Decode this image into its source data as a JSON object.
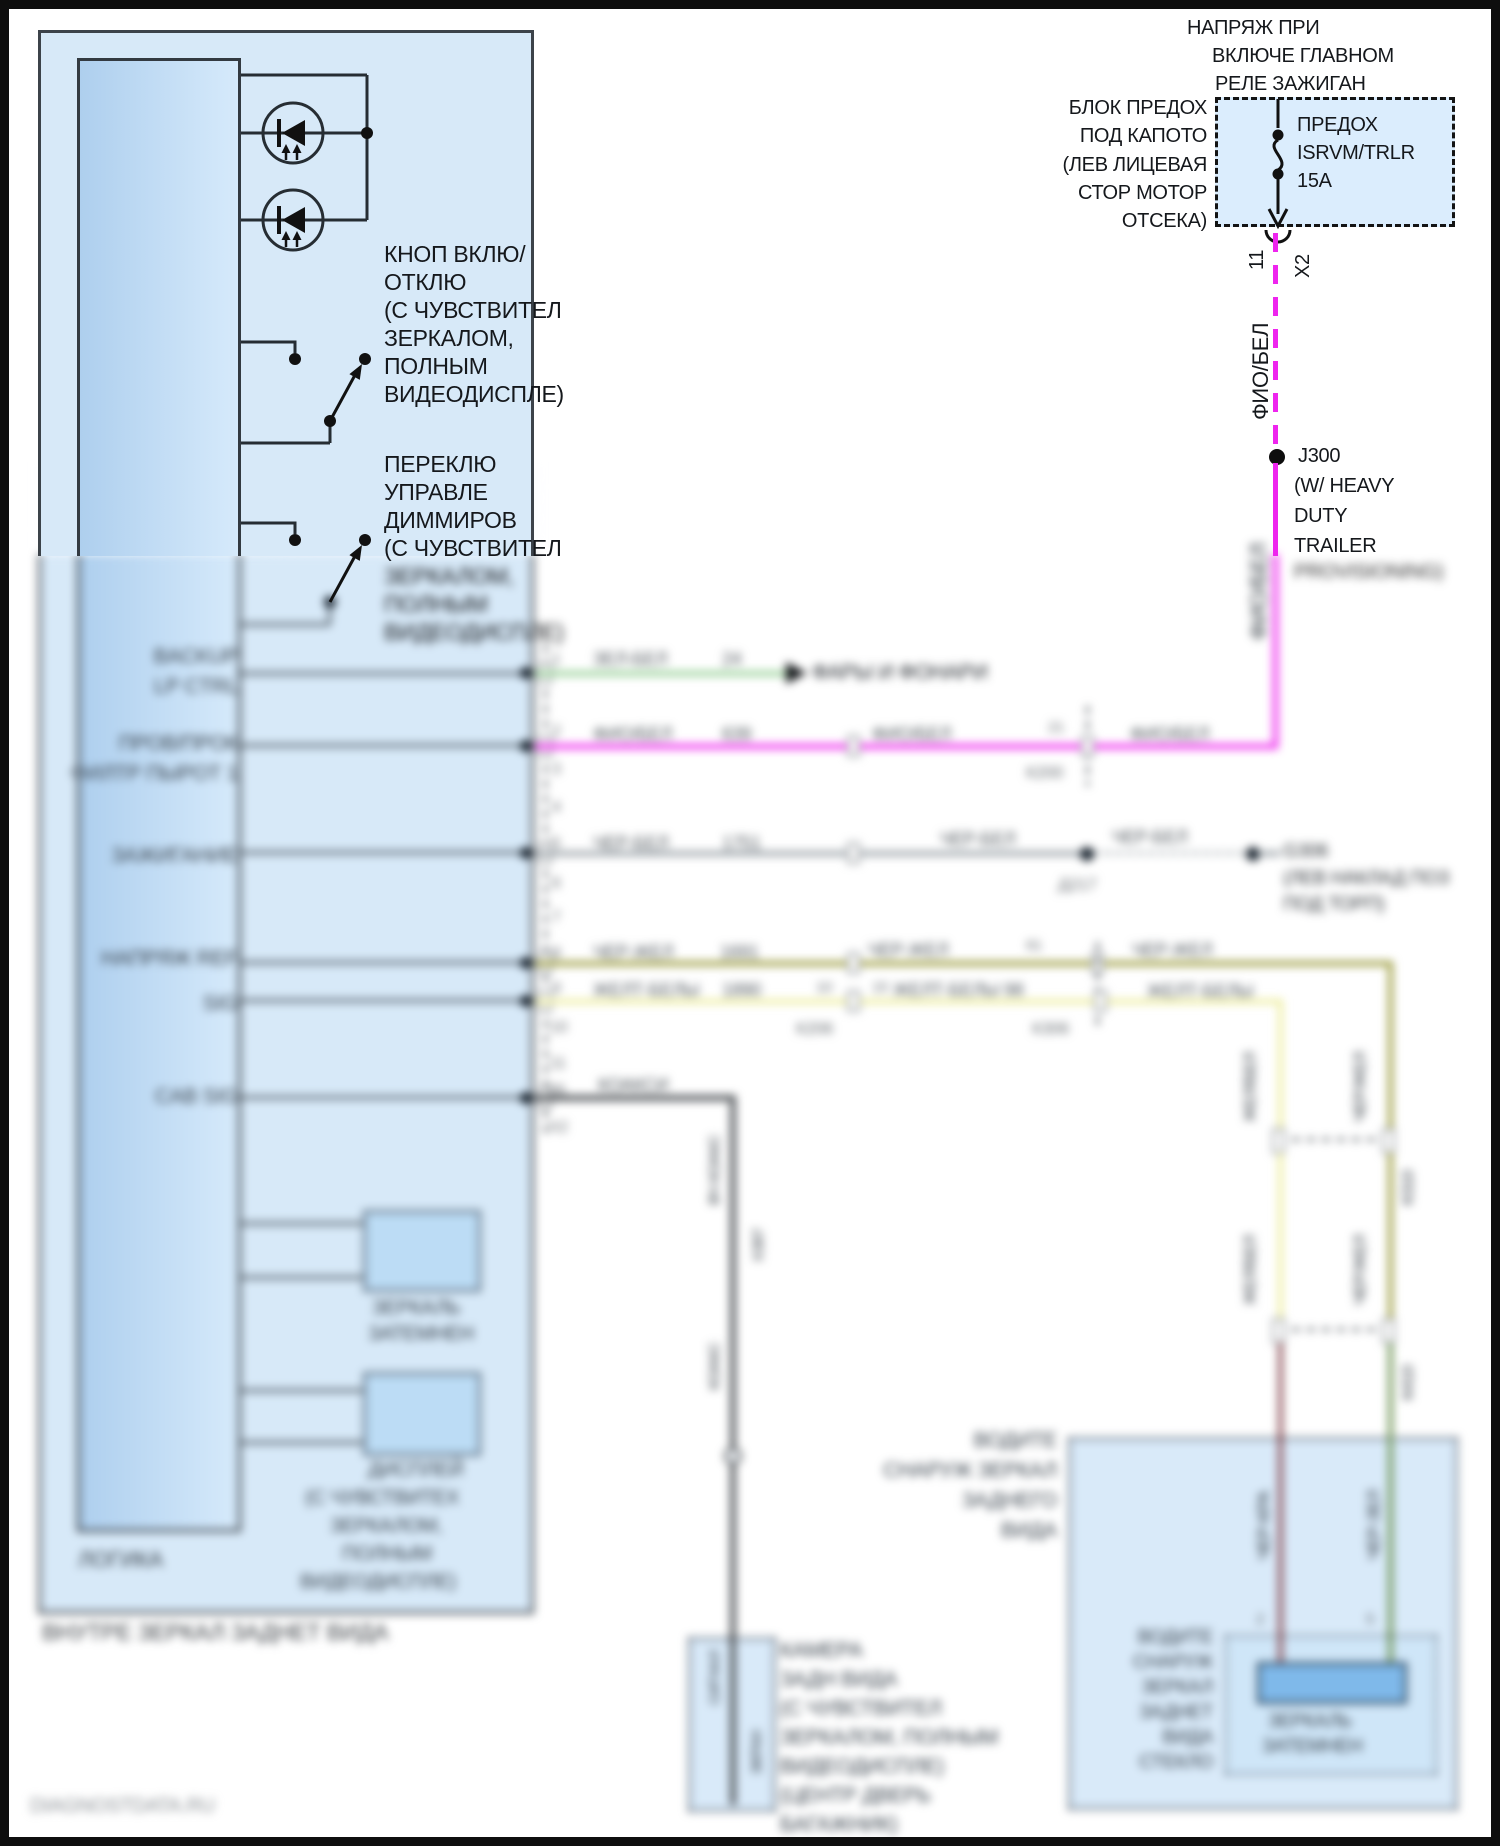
{
  "diagram": {
    "watermark": "DIAGNOSTDATA.RU",
    "colors": {
      "wire_magenta": "#ee25ee",
      "wire_green": "#95cf95",
      "wire_gray": "#9aa2a8",
      "wire_olive": "#9c9c3e",
      "wire_yellow": "#ededa0",
      "wire_coax": "#54585c",
      "wire_maroon": "#8c5158",
      "wire_dark_green": "#6f9455",
      "module_fill": "#d7e9f8",
      "fuse_fill": "#dbedfd",
      "frame": "#0e0e0e"
    },
    "supply": {
      "title_1": "НАПРЯЖ ПРИ",
      "title_2": "ВКЛЮЧЕ ГЛАВНОМ",
      "title_3": "РЕЛЕ ЗАЖИГАН",
      "block_1": "БЛОК ПРЕДОХ",
      "block_2": "ПОД КАПОТО",
      "block_3": "(ЛЕВ ЛИЦЕВАЯ",
      "block_4": "СТОР МОТОР",
      "block_5": "ОТСЕКА)",
      "fuse_1": "ПРЕДОХ",
      "fuse_2": "ISRVM/TRLR",
      "fuse_3": "15A",
      "pin": "11",
      "connector": "X2",
      "wire_color": "ФИО/БЕЛ",
      "splice": "J300",
      "splice_2": "(W/ HEAVY",
      "splice_3": "DUTY",
      "splice_4": "TRAILER",
      "splice_5": "PROVISIONING)",
      "wire_color_2": "ФИО/БЕЛ"
    },
    "module": {
      "name": "ЛОГИКА",
      "footer": "ВНУТРЕ ЗЕРКАЛ ЗАДНЕТ ВИДА",
      "button_1": "КНОП ВКЛЮ/",
      "button_2": "ОТКЛЮ",
      "button_3": "(С ЧУВСТВИТЕЛ",
      "button_4": "ЗЕРКАЛОМ,",
      "button_5": "ПОЛНЫМ",
      "button_6": "ВИДЕОДИСПЛЕ)",
      "dimmer_1": "ПЕРЕКЛЮ",
      "dimmer_2": "УПРАВЛЕ",
      "dimmer_3": "ДИММИРОВ",
      "dimmer_4": "(С ЧУВСТВИТЕЛ",
      "dimmer_5": "ЗЕРКАЛОМ,",
      "dimmer_6": "ПОЛНЫМ",
      "dimmer_7": "ВИДЕОДИСПЛЕ)",
      "pin_a1": "BACKUP",
      "pin_a2": "LP CTRL",
      "pin_b1": "ПРОВ/ПРОК",
      "pin_b2": "ФИЛТР ПЫРОТ 1",
      "pin_c": "ЗАЖИГАНИЕ",
      "pin_d": "НАПРЯЖ REF",
      "pin_e": "SIG",
      "pin_f": "CAB SIG",
      "mirror_box_1": "ЗЕРКАЛЬ",
      "mirror_box_2": "ЗАТЕМНЕН",
      "display_box_1": "ДИСПЛЕЙ",
      "display_box_2": "(С ЧУВСТВИТЕХ",
      "display_box_3": "ЗЕРКАЛОМ,",
      "display_box_4": "ПОЛНЫМ",
      "display_box_5": "ВИДЕОДИСПЛЕ)"
    },
    "pins": {
      "p1": "1",
      "p2": "2",
      "p3": "3",
      "p4": "4",
      "p5": "5",
      "p6": "6",
      "p7": "7",
      "p8": "8",
      "p9": "9",
      "p10": "10",
      "p11": "11",
      "p26": "26",
      "x2": "X2"
    },
    "rows": {
      "r1": {
        "color": "ЗЕЛ-БЕЛ",
        "circuit": "24",
        "target": "ФАРЫ И ФОНАРИ"
      },
      "r2": {
        "color": "ФИО/БЕЛ",
        "circuit": "639",
        "color_r": "ФИО/БЕЛ",
        "pin_l": "21",
        "conn": "К200",
        "color_r2": "ФИО/БЕЛ",
        "vlabel": "ФИО/БЕЛ"
      },
      "r3": {
        "color": "ЧЕР-БЕЛ",
        "circuit": "1751",
        "color_r": "ЧЕР-БЕЛ",
        "splice": "Д217",
        "color_r2": "ЧЕР-БЕЛ",
        "ground": "G306",
        "ground_1": "(ЛЕВ НАКЛАД ПОЗ",
        "ground_2": "ПОД ТОРП)"
      },
      "r4": {
        "color": "ЧЕР-ЖЕЛ",
        "circuit": "1691",
        "color_r": "ЧЕР-ЖЕЛ",
        "pin_l": "61",
        "color_r2": "ЧЕР-ЖЕЛ"
      },
      "r5": {
        "color": "ЖЕЛТ-БЕЛЫ",
        "circuit": "1890",
        "pin_l": "10",
        "pin_r": "15",
        "color_r": "ЖЕЛТ-БЕЛЫ 98",
        "conn_a": "К206",
        "conn_b": "К306",
        "color_r2": "ЖЕЛТ-БЕЛЫ"
      },
      "r6": {
        "label": "КОАКСИ"
      }
    },
    "verticals": {
      "yb_top": "ЖЕЛ/БЕЛ",
      "cy_top": "ЧЕР/ЖЕЛ",
      "yb_mid": "ЖЕЛ/БЕЛ",
      "cy_mid": "ЧЕР/ЖЕЛ",
      "k_mid": "К310",
      "k_low": "К410",
      "red_label": "ЧЕР-КРА",
      "green_label": "ЧЕР-ЗЕЛ",
      "pin_red": "2",
      "pin_green": "5",
      "coax_a": "ВЧ КОАКС",
      "coax_x": "X387",
      "coax_b": "КОАКС",
      "coax_c": "СИГНАЛ",
      "coax_d": "ЭКРАН"
    },
    "camera": {
      "l1": "КАМЕРА",
      "l2": "ЗАДН ВИДА",
      "l3": "(С ЧУВСТВИТЕЛ",
      "l4": "ЗЕРКАЛОМ, ПОЛНЫМ",
      "l5": "ВИДЕОДИСПЛЕ)",
      "l6": "(ЦЕНТР ДВЕРЬ",
      "l7": "БАГАЖНИК)"
    },
    "mirror_glass": {
      "out_1": "ВОДИТЕ",
      "out_2": "СНАРУЖ ЗЕРКАЛ",
      "out_3": "ЗАДНЕГО",
      "out_4": "ВИДА",
      "in_1": "ВОДИТЕ",
      "in_2": "СНАРУЖ",
      "in_3": "ЗЕРКАЛ",
      "in_4": "ЗАДНЕТ",
      "in_5": "ВИДА",
      "in_6": "СТЕКЛО",
      "el_1": "ЗЕРКАЛЬ",
      "el_2": "ЗАТЕМНЕН"
    }
  }
}
